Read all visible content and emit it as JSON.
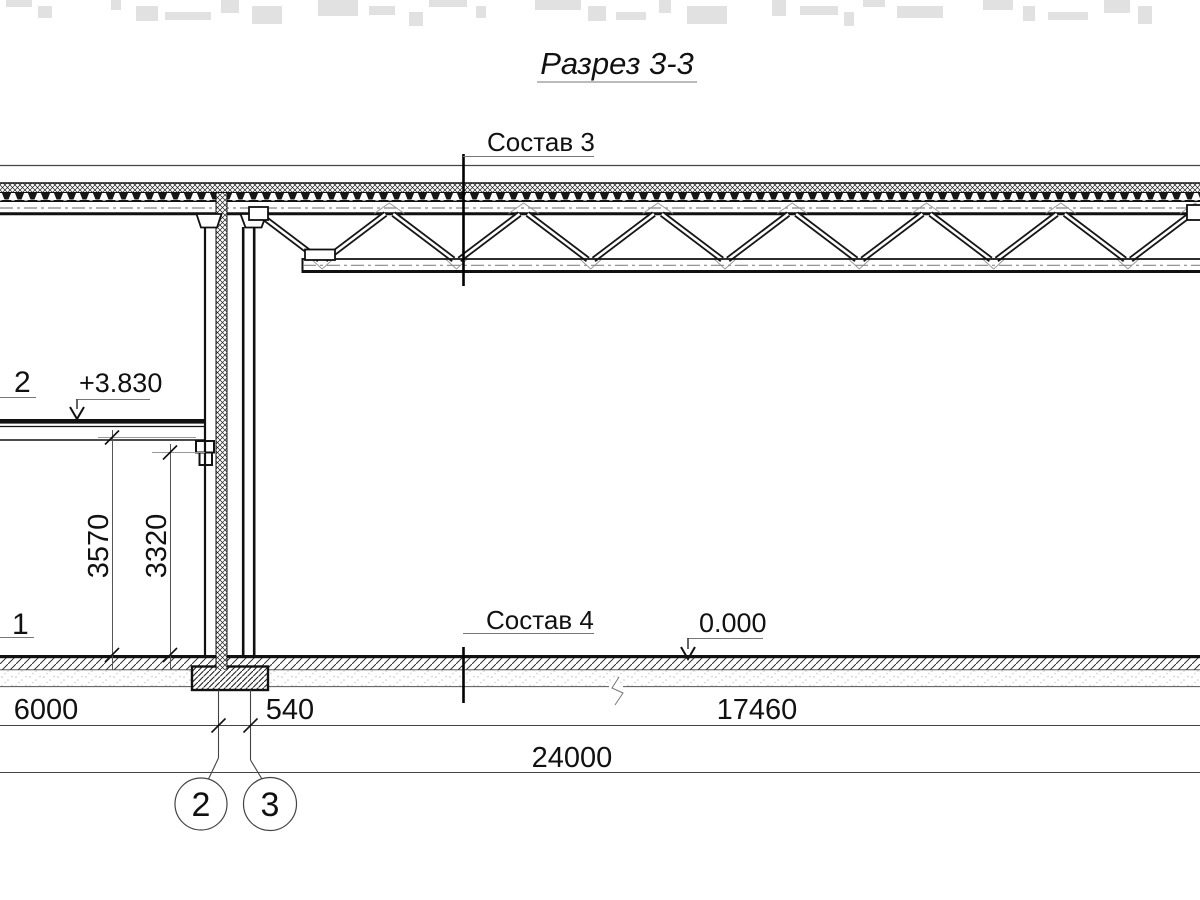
{
  "title": {
    "text": "Разрез 3-3"
  },
  "labels": {
    "composition3": "Состав 3",
    "composition4": "Состав 4",
    "elevation_top": "+3.830",
    "elevation_zero": "0.000",
    "edge_label_2": "2",
    "edge_label_1": "1"
  },
  "dimensions": {
    "wall_height_3570": "3570",
    "wall_height_3320": "3320",
    "bay_6000": "6000",
    "bay_540": "540",
    "bay_17460": "17460",
    "total_24000": "24000"
  },
  "grid_axes": {
    "axis_a": "2",
    "axis_b": "3"
  }
}
